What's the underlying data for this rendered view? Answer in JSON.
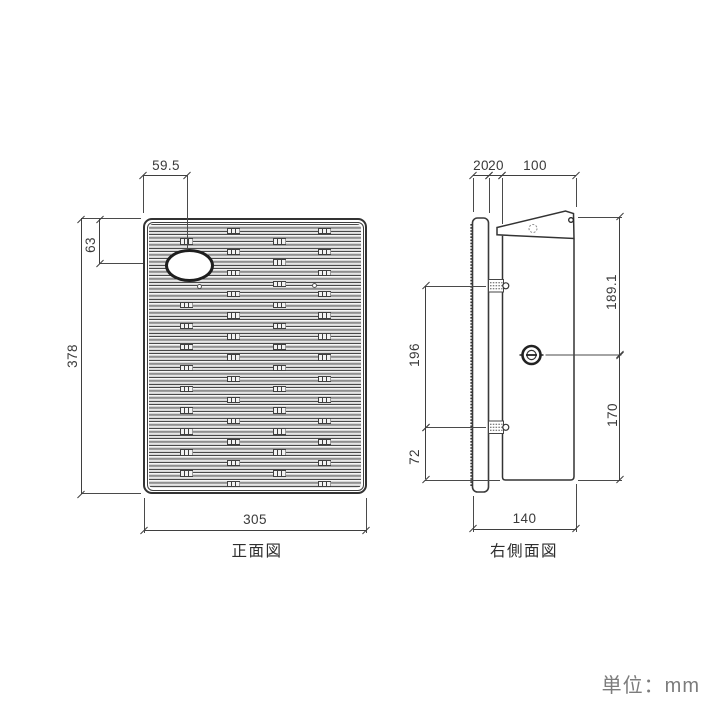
{
  "unit_note": "単位：mm",
  "front_view": {
    "label": "正面図",
    "dimensions": {
      "slot_center_from_left": "59.5",
      "slot_center_from_top": "63",
      "overall_height": "378",
      "overall_width": "305"
    }
  },
  "side_view": {
    "label": "右側面図",
    "dimensions": {
      "back_plate_depth": "20",
      "gap_depth": "20",
      "body_depth": "100",
      "upper_height": "189.1",
      "bracket_spacing": "196",
      "knob_height": "170",
      "lower_bracket_height": "72",
      "overall_depth": "140"
    }
  }
}
